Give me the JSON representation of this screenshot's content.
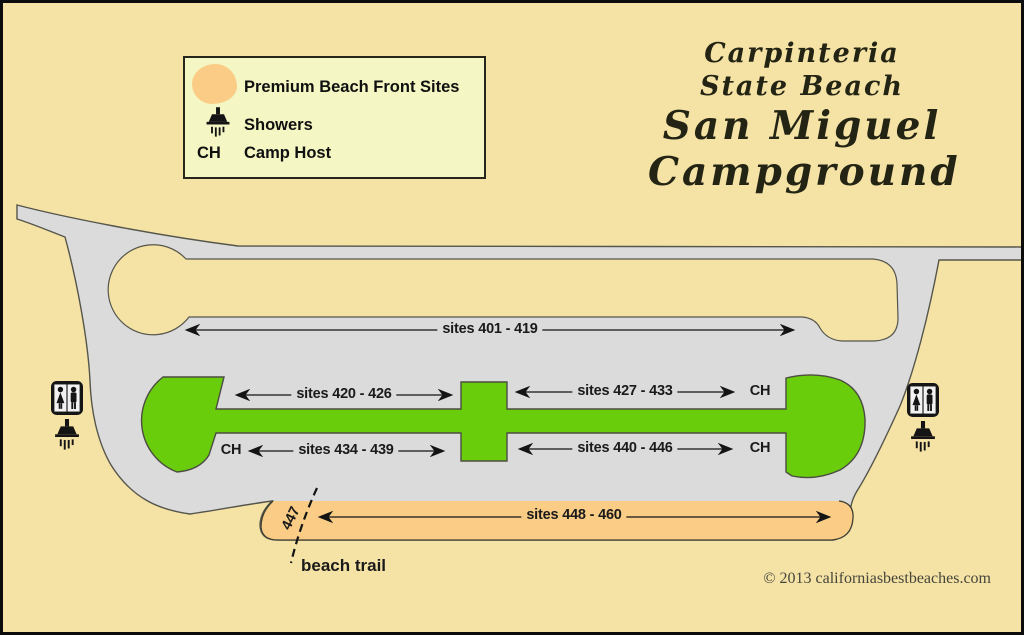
{
  "page": {
    "background_color": "#F5E3A6",
    "border_color": "#0c0c0c"
  },
  "title": {
    "line1": "Carpinteria",
    "line2": "State Beach",
    "line3": "San Miguel",
    "line4": "Campground"
  },
  "legend": {
    "premium_label": "Premium Beach Front Sites",
    "showers_label": "Showers",
    "camp_host_abbr": "CH",
    "camp_host_label": "Camp Host"
  },
  "map": {
    "row_401_419": "sites 401 - 419",
    "row_420_426": "sites 420 - 426",
    "row_427_433": "sites 427 - 433",
    "row_434_439": "sites 434 - 439",
    "row_440_446": "sites 440 - 446",
    "row_448_460": "sites 448 - 460",
    "site_447": "447",
    "beach_trail_label": "beach trail",
    "camp_host_abbr": "CH"
  },
  "colors": {
    "road_gray": "#DBDBDB",
    "campsite_green": "#69CD0C",
    "premium_orange": "#FACC86",
    "legend_background": "#F4F6C3"
  },
  "footer": {
    "copyright": "© 2013 californiasbestbeaches.com"
  }
}
